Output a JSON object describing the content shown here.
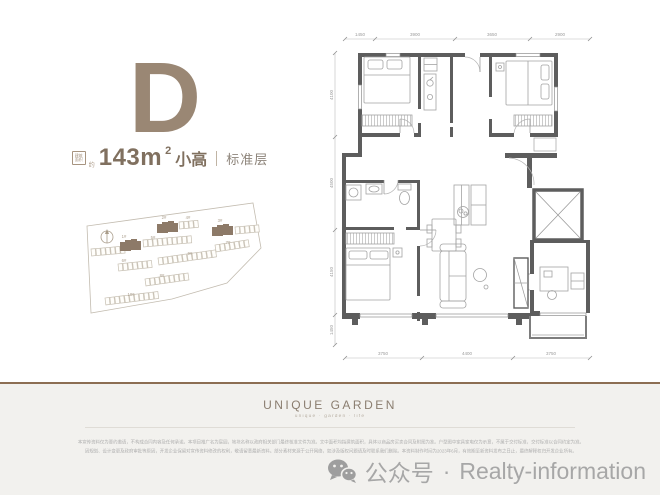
{
  "colors": {
    "accent_taupe": "#9a8774",
    "highlight_building": "#8d7a68",
    "wall_gray": "#5d5d5d",
    "divider_brown": "#8c6e53",
    "footer_bg": "#f2f1ee",
    "watermark_gray": "#a7a7a7",
    "siteplan_line": "#c3bcb0"
  },
  "unit": {
    "letter": "D",
    "area_icon_line1": "建筑",
    "area_icon_line2": "面积",
    "approx": "约",
    "area_value": "143m",
    "area_sup": "2",
    "area_type": "小高",
    "floor_type": "标准层"
  },
  "siteplan": {
    "labels": [
      "1#",
      "2#",
      "3#",
      "4#",
      "5#",
      "6#",
      "7#",
      "8#",
      "9#",
      "10#"
    ]
  },
  "floorplan": {
    "dims_top": [
      "1450",
      "3900",
      "3650",
      "2900"
    ],
    "dims_bottom": [
      "3750",
      "4400",
      "3750"
    ],
    "dims_left": [
      "4100",
      "4500",
      "4150",
      "1450"
    ]
  },
  "footer": {
    "brand": "UNIQUE GARDEN",
    "tagline": "unique · garden · life",
    "disclaimer_line1": "本宣传资料仅为要约邀请，不构成合同内容及任何承诺。本项目推广名为宸园，地块名称以政府相关部门最终核准文件为准。文中面积均指建筑面积，具体以商品房买卖合同及附图为准。户型图中家具家电仅为示意，不属于交付标准，交付标准以合同约定为准。",
    "disclaimer_line2": "因规划、设计变更及政府审批等原因，开发企业保留对宣传资料修改的权利，敬请留意最新资料。部分素材来源于公开网络，如涉及版权问题请及时联系我们删除。本资料制作时间为2023年6月，有效期至新资料发布之日止，最终解释权归开发企业所有。",
    "watermark_platform": "公众号",
    "watermark_sep": "·",
    "watermark_name": "Realty-information"
  }
}
